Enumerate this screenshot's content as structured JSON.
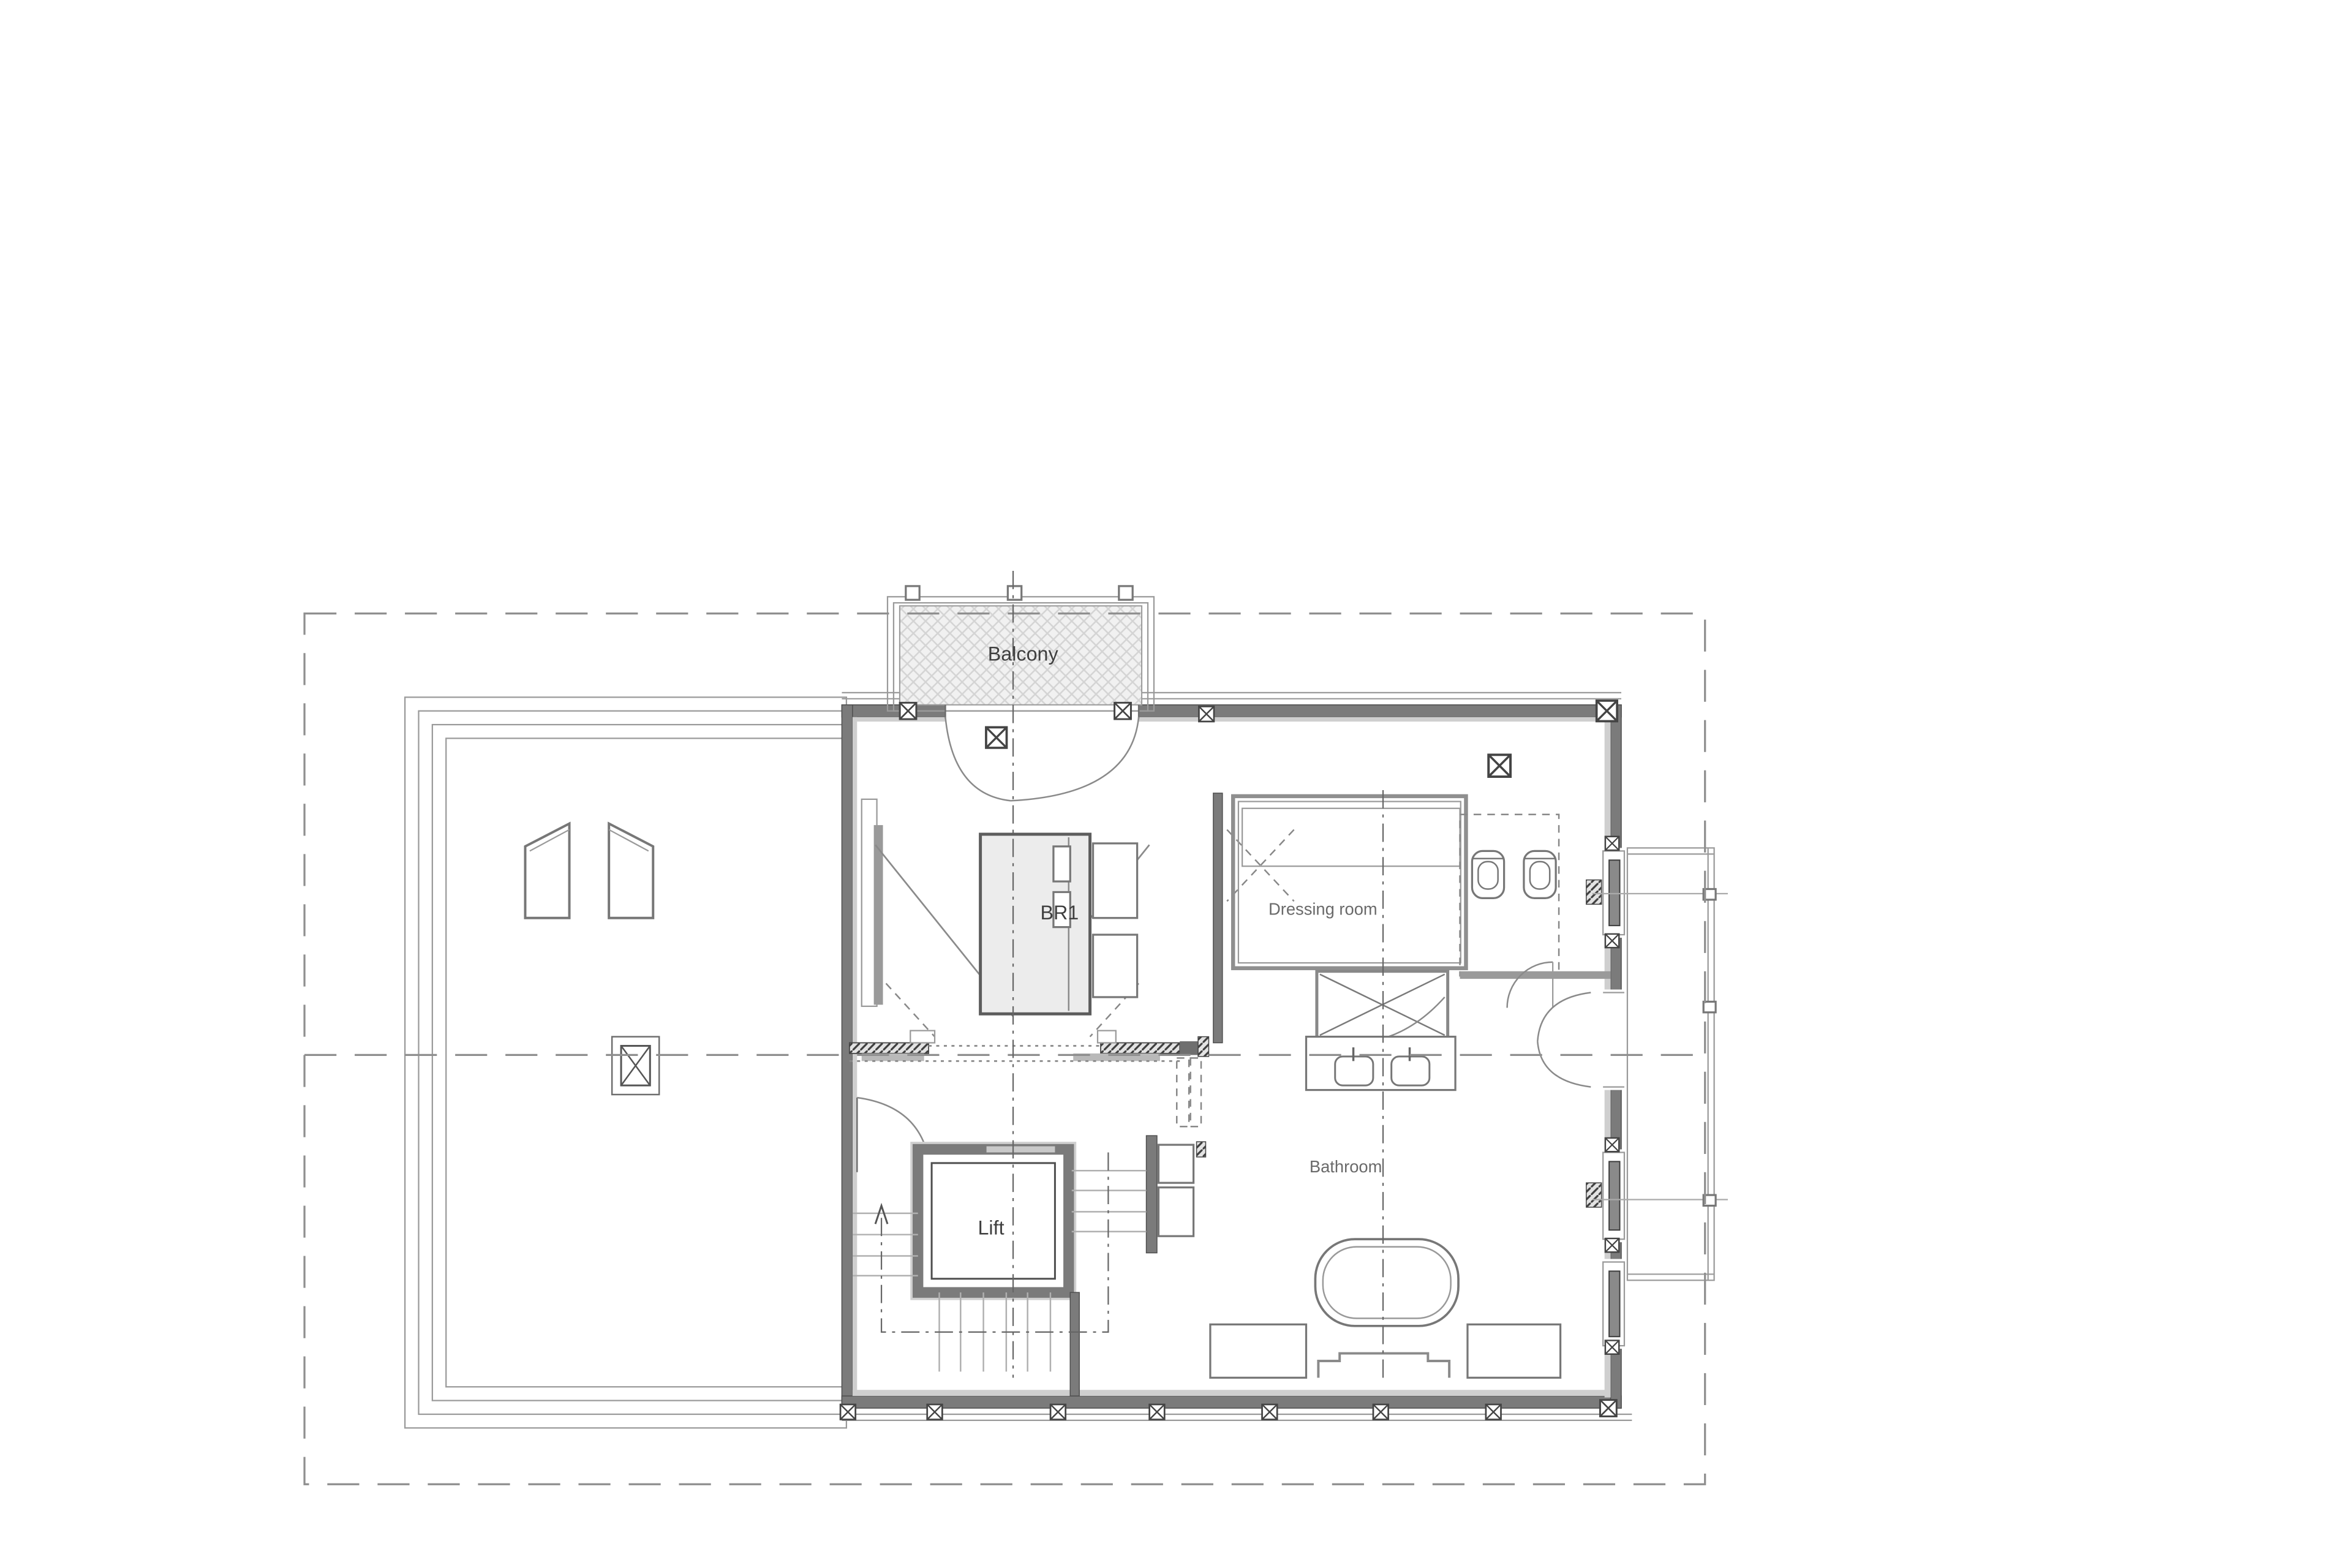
{
  "plan": {
    "title": "First floor plan",
    "labels": {
      "balcony": "Balcony",
      "br1": "BR1",
      "dressing_room": "Dressing room",
      "bathroom": "Bathroom",
      "lift": "Lift"
    },
    "colors": {
      "wall_dark": "#7b7b7b",
      "wall_light": "#cfcfcf",
      "dashed_lines": "#8f8f8f",
      "label_text": "#3f3f3f",
      "secondary_text": "#6a6a6a",
      "bed_fill": "#ececec",
      "balcony_hatch": "#f1f1f1"
    },
    "symbols": [
      "skylight-icon",
      "chimney-icon",
      "post-marker-icon",
      "stair-up-arrow-icon",
      "double-door-icon",
      "shower-icon",
      "bathtub-icon",
      "toilet-icon",
      "bidet-icon"
    ]
  }
}
